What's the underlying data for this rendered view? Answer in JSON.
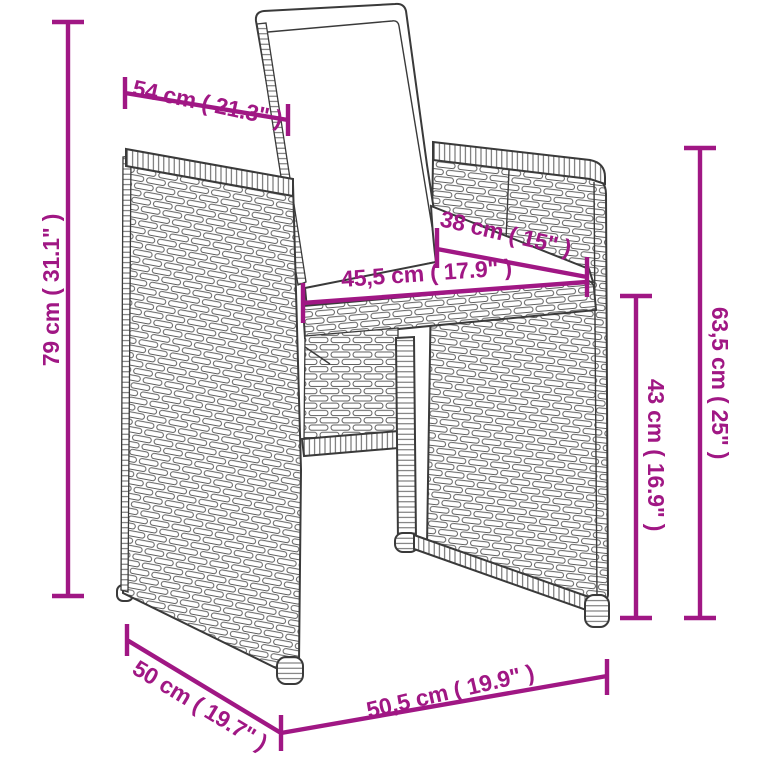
{
  "alt_text": "Line drawing of a poly rattan garden dining chair with back and seat cushions, annotated with product dimensions",
  "colors": {
    "dim": "#A01784",
    "line": "#3A3A3A",
    "line_soft": "#5C5C5C",
    "background": "#FFFFFF"
  },
  "dims": {
    "back_width": "54 cm ( 21.3\" )",
    "total_height": "79 cm ( 31.1\" )",
    "seat_depth": "38 cm ( 15\" )",
    "seat_width": "45,5 cm ( 17.9\" )",
    "armrest_height": "63,5 cm ( 25\" )",
    "seat_height": "43 cm ( 16.9\" )",
    "depth": "50 cm ( 19.7\" )",
    "base_width": "50,5 cm ( 19.9\" )"
  }
}
